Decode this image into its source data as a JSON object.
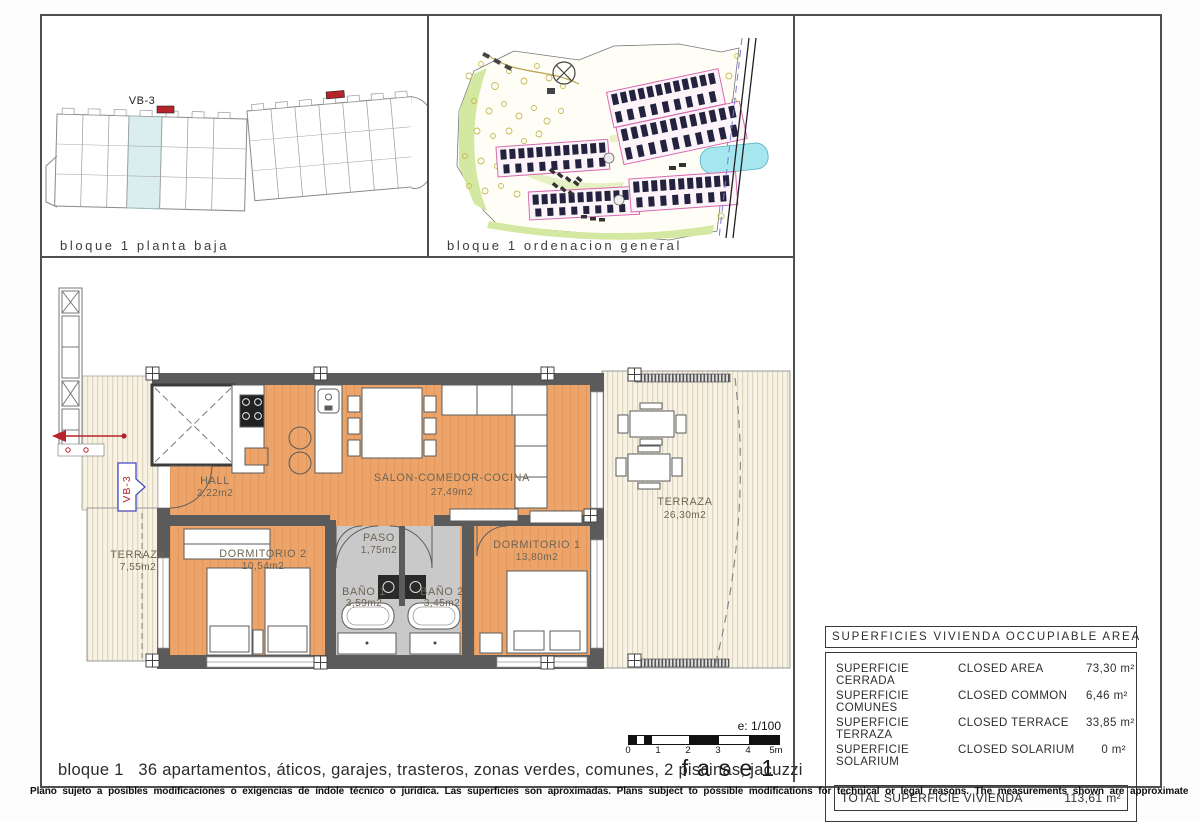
{
  "colors": {
    "floor_orange": "#eca46a",
    "wall_gray": "#5b5b5b",
    "bath_gray": "#c9c9c9",
    "deck_cream": "#f7f2e3",
    "accent_red": "#b5242a",
    "tag_blue": "#4a4ac0",
    "site_magenta": "#d86ab0",
    "label_brown": "#6e6554"
  },
  "panel_planta_baja": {
    "caption": "bloque 1 planta baja",
    "unit_label": "VB-3"
  },
  "panel_ordenacion": {
    "caption": "bloque 1 ordenacion general"
  },
  "floorplan": {
    "unit_tag": "VB-3",
    "rooms": {
      "hall": {
        "name": "HALL",
        "area": "2,22m2"
      },
      "salon": {
        "name": "SALON-COMEDOR-COCINA",
        "area": "27,49m2"
      },
      "paso": {
        "name": "PASO",
        "area": "1,75m2"
      },
      "dormitorio2": {
        "name": "DORMITORIO 2",
        "area": "10,54m2"
      },
      "dormitorio1": {
        "name": "DORMITORIO 1",
        "area": "13,80m2"
      },
      "bano1": {
        "name": "BAÑO 1",
        "area": "3,59m2"
      },
      "bano2": {
        "name": "BAÑO 2",
        "area": "3,45m2"
      },
      "terraza_left": {
        "name": "TERRAZA",
        "area": "7,55m2"
      },
      "terraza_right": {
        "name": "TERRAZA",
        "area": "26,30m2"
      }
    },
    "scale_label": "e: 1/100",
    "scale_ticks": [
      "0",
      "1",
      "2",
      "3",
      "4",
      "5m"
    ],
    "phase_label": "fase1",
    "caption": "bloque 1   36 apartamentos, áticos, garajes, trasteros, zonas verdes, comunes, 2 piscinas, jacuzzi"
  },
  "areas_table": {
    "title": "SUPERFICIES VIVIENDA OCCUPIABLE AREA",
    "rows": [
      {
        "es": "SUPERFICIE CERRADA",
        "en": "CLOSED AREA",
        "value": "73,30 m²"
      },
      {
        "es": "SUPERFICIE COMUNES",
        "en": "CLOSED COMMON",
        "value": "6,46 m²"
      },
      {
        "es": "SUPERFICIE TERRAZA",
        "en": "CLOSED TERRACE",
        "value": "33,85 m²"
      },
      {
        "es": "SUPERFICIE SOLARIUM",
        "en": "CLOSED SOLARIUM",
        "value": "0 m²"
      }
    ],
    "total_label": "TOTAL SUPERFICIE VIVIENDA",
    "total_value": "113,61 m²"
  },
  "footer": {
    "note": "Plano sujeto a posibles modificaciones o exigencias de índole técnico o jurídica. Las superficies son aproximadas. Plans subject to possible modifications for technical or legal reasons. The measurements shown are approximate"
  }
}
